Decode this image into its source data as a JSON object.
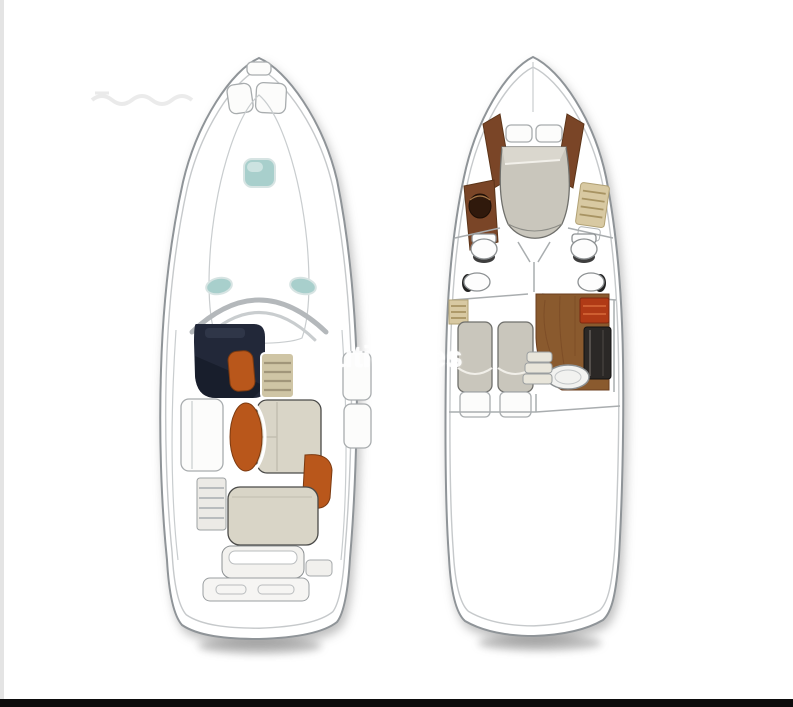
{
  "image": {
    "description": "Scanned brochure page showing two top-view yacht floor plans side by side: main deck plan (left) and lower accommodation deck plan (right), with a white watermark across the middle",
    "background": "#ffffff"
  },
  "watermark": {
    "text": "nauticsales",
    "logo_icon": "check-swoosh-icon",
    "color": "#ffffff"
  },
  "plans": {
    "left": {
      "name": "main-deck-plan",
      "features": [
        "bow-anchor-lockers",
        "foredeck-teal-hatch",
        "side-deck-vents",
        "windshield-arch",
        "helm-console",
        "helm-seat",
        "wet-bar-cabinet",
        "cockpit-dinette",
        "oval-table",
        "side-benches",
        "aft-facing-seat",
        "transom-steps",
        "engine-hatch-sunpad",
        "transom-bench",
        "swim-platform"
      ]
    },
    "right": {
      "name": "lower-deck-plan",
      "features": [
        "v-berth-island-bed",
        "bow-pillows",
        "wood-trim-panels",
        "port-vanity-sink",
        "starboard-shelf-steps",
        "port-head-toilet-sink",
        "starboard-head-toilet-sink",
        "twin-guest-beds",
        "galley-wood-floor",
        "stove",
        "refrigerator",
        "galley-sink",
        "companionway-steps"
      ]
    }
  },
  "colors": {
    "pageBg": "#ffffff",
    "edgeStrip": "#e4e4e4",
    "bottomBar": "#0c0c0c",
    "hullStroke": "#8f9498",
    "hullInner": "#c6c9cb",
    "shadow": "#8f8f8f",
    "navy": "#222839",
    "navyDark": "#161b28",
    "orange": "#b9571b",
    "orangeDark": "#7c3a10",
    "beige": "#d9d5c7",
    "tan": "#cfc5a5",
    "tanLine": "#a1967a",
    "tanStep": "#d8c9a2",
    "teal": "#a8cfcc",
    "tealLight": "#d2e6e4",
    "wood": "#7a4527",
    "woodLight": "#8a5a2e",
    "stove": "#b03a16",
    "appliance": "#2b2826",
    "bedGray": "#c9c6bc",
    "watermark": "#ffffff"
  }
}
